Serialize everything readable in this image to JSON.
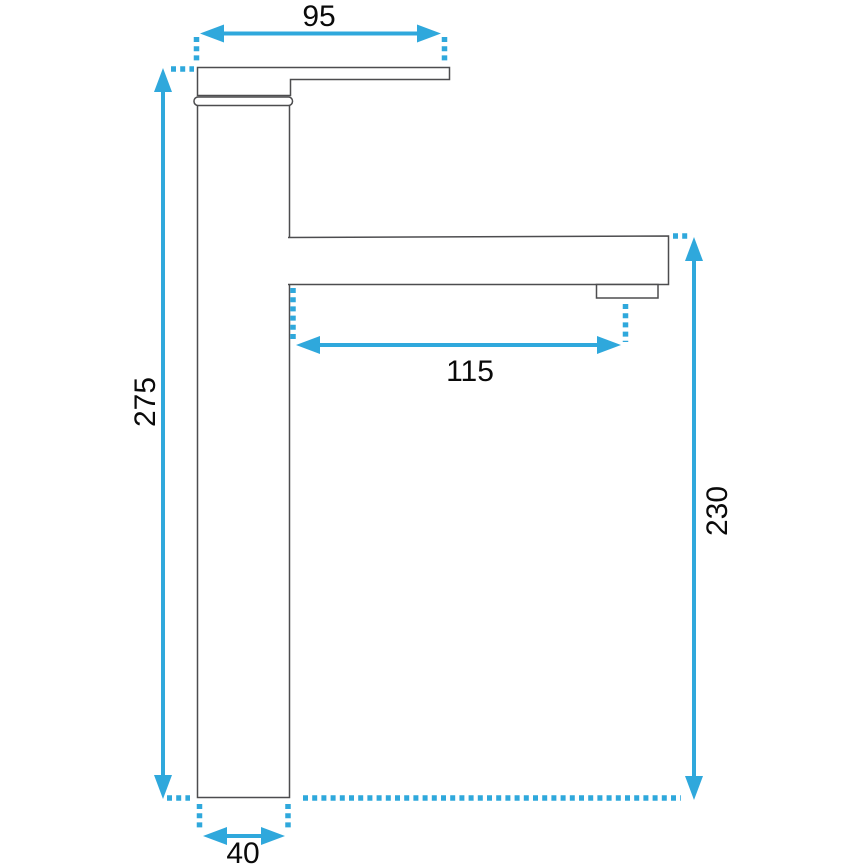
{
  "drawing": {
    "subject": "tall-basin-faucet-side-view-dimension-drawing",
    "dimensions": {
      "top_width": "95",
      "total_height": "275",
      "spout_reach": "115",
      "spout_height": "230",
      "base_width": "40"
    },
    "colors": {
      "dimension": "#2fa8dc",
      "outline": "#4d4d4f",
      "label": "#0a0a0a",
      "background": "#ffffff"
    }
  }
}
